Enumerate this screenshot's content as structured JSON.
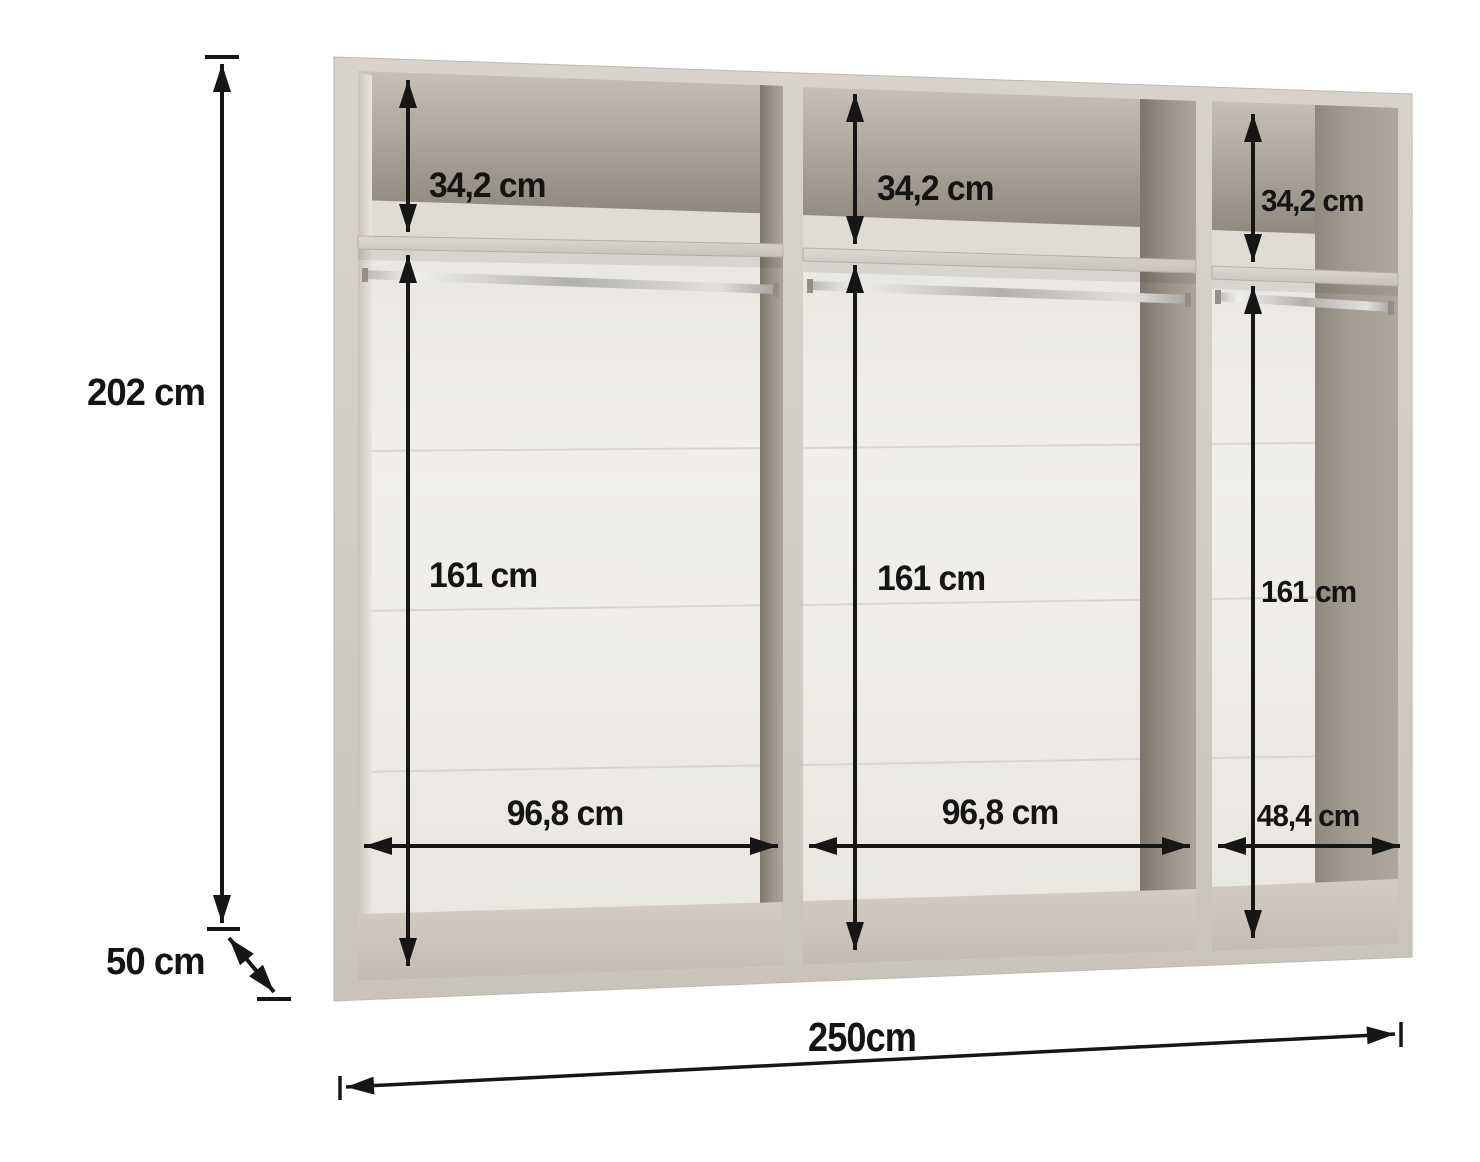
{
  "wardrobe": {
    "overall": {
      "height": "202 cm",
      "depth": "50 cm",
      "width": "250cm"
    },
    "compartments": [
      {
        "position": "left",
        "top_shelf_height": "34,2 cm",
        "hanging_section_height": "161 cm",
        "inner_width": "96,8 cm"
      },
      {
        "position": "middle",
        "top_shelf_height": "34,2 cm",
        "hanging_section_height": "161 cm",
        "inner_width": "96,8 cm"
      },
      {
        "position": "right",
        "top_shelf_height": "34,2 cm",
        "hanging_section_height": "161 cm",
        "inner_width": "48,4 cm"
      }
    ],
    "colors": {
      "dimension_ink": "#161616",
      "carcass": "#d3cec7",
      "back_wall": "#edebe7",
      "background": "#ffffff"
    }
  }
}
